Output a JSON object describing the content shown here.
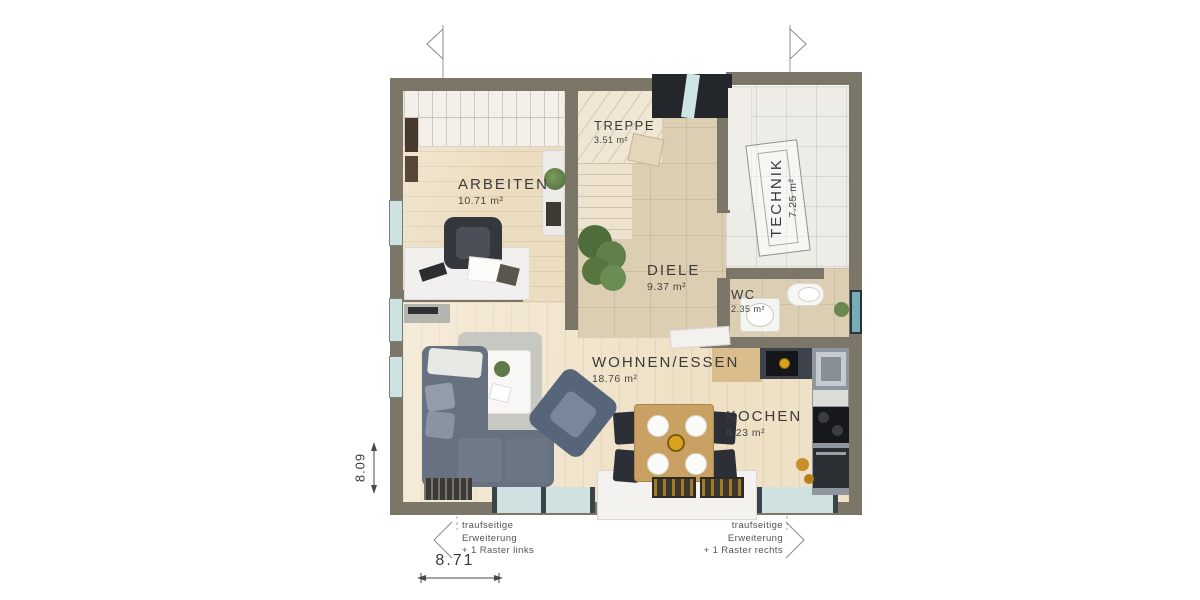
{
  "plan": {
    "rooms": [
      {
        "id": "arbeiten",
        "label": "ARBEITEN",
        "area": "10.71 m²"
      },
      {
        "id": "treppe",
        "label": "TREPPE",
        "area": "3.51 m²"
      },
      {
        "id": "technik",
        "label": "TECHNIK",
        "area": "7.25 m²"
      },
      {
        "id": "diele",
        "label": "DIELE",
        "area": "9.37 m²"
      },
      {
        "id": "wc",
        "label": "WC",
        "area": "2.35 m²"
      },
      {
        "id": "wohnen",
        "label": "WOHNEN/ESSEN",
        "area": "18.76 m²"
      },
      {
        "id": "kochen",
        "label": "KOCHEN",
        "area": "6.23 m²"
      }
    ],
    "dimensions": {
      "width": "8.71",
      "height": "8.09"
    },
    "annotations": {
      "left": [
        "traufseitige",
        "Erweiterung",
        "+ 1 Raster links"
      ],
      "right": [
        "traufseitige",
        "Erweiterung",
        "+ 1 Raster rechts"
      ]
    },
    "colors": {
      "wall": "#7b7668",
      "wood_floor": "#ecddc0",
      "tile_floor": "#dbcEB3",
      "technik_floor": "#edece6",
      "stairs": "#efe6d3",
      "glass": "#cfe1e0",
      "sofa": "#687180",
      "accent_gold": "#d9a21b",
      "entrance_dark": "#23262b"
    }
  }
}
